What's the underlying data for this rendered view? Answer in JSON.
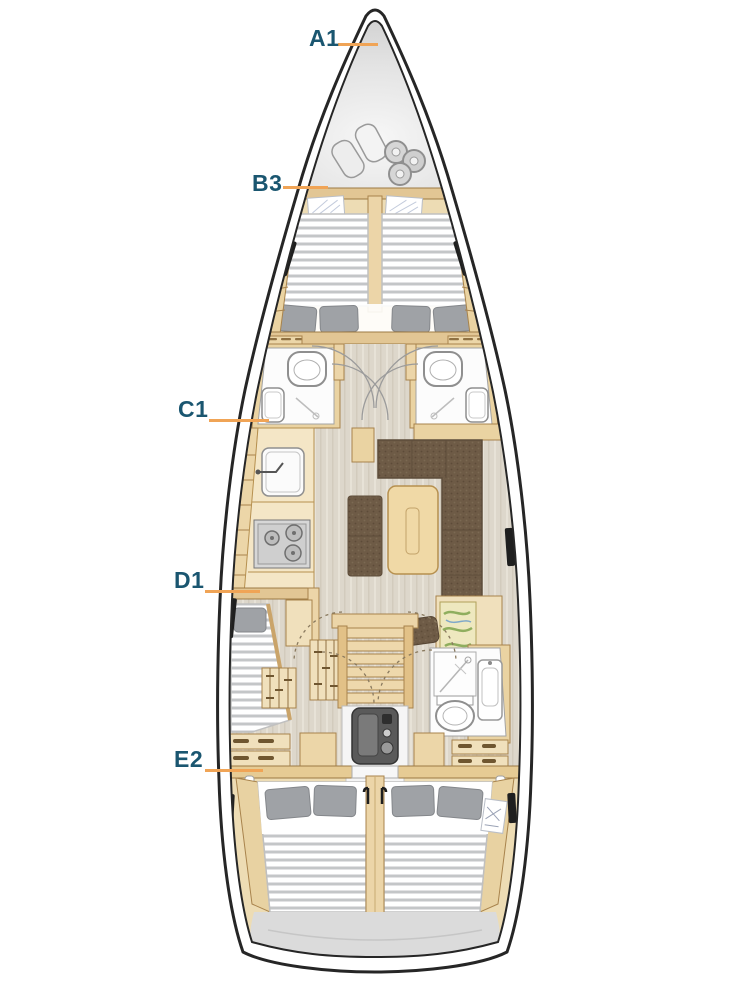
{
  "diagram": {
    "type": "sailing-yacht deck layout plan",
    "labels": [
      {
        "id": "A1",
        "text": "A1"
      },
      {
        "id": "B3",
        "text": "B3"
      },
      {
        "id": "C1",
        "text": "C1"
      },
      {
        "id": "D1",
        "text": "D1"
      },
      {
        "id": "E2",
        "text": "E2"
      }
    ],
    "colors": {
      "label_text": "#1a5670",
      "leader_line": "#f0a456",
      "hull_outline": "#262626",
      "wood_deck": "#eddcb4",
      "wood_furniture": "#f0e0bc",
      "wood_outline": "#a8834c",
      "floor_gray": "#ddd7cb",
      "sofa_brown": "#6e5b46",
      "pillow_gray": "#9fa2a6",
      "mattress_stripe": "#c4c6c8",
      "locker_gray": "#c6c6c6",
      "transom_gray": "#dbdbdb",
      "fixture_white": "#fcfcfc"
    }
  }
}
